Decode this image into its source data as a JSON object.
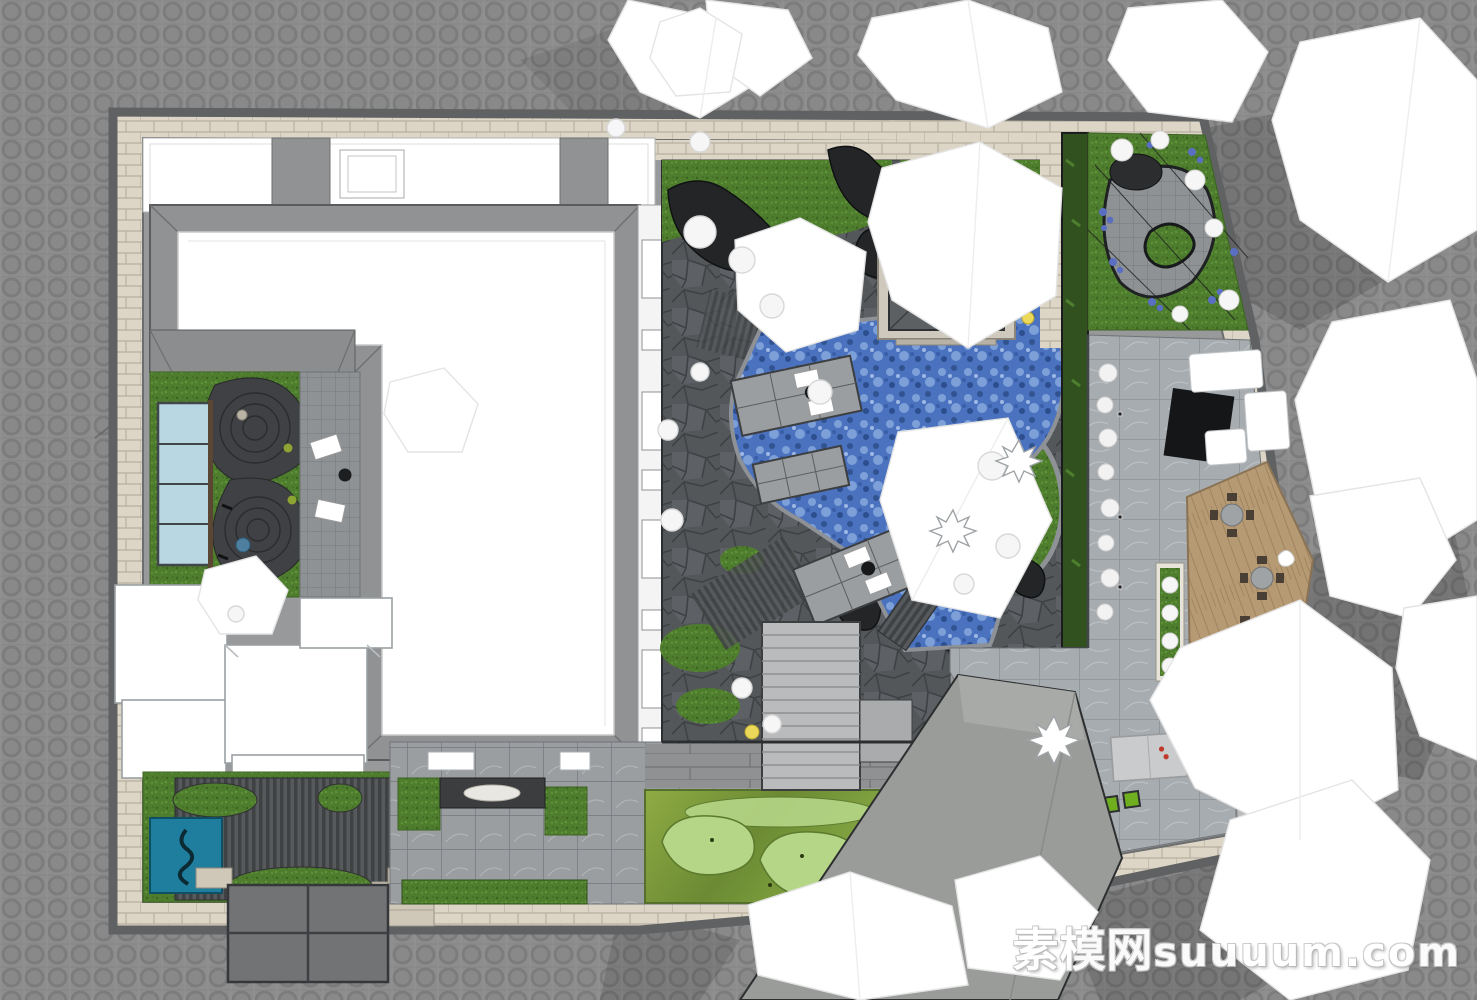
{
  "meta": {
    "view": "top-down-courtyard-landscape-plan",
    "render_style": "sketchup-axon-texture-render"
  },
  "watermark": {
    "cn": "素模网",
    "en": "suuuum.com"
  },
  "palette": {
    "bg": "#8d8d8d",
    "bgline": "#7c7c7c",
    "brick": "#ddd6c6",
    "brickline": "#b7afa0",
    "wall": "#909294",
    "walledge": "#5f6163",
    "roofwhite": "#ffffff",
    "grass": "#4e7d2d",
    "water": "#4a72bf",
    "rock": "#232527",
    "flag": "#54575a",
    "marble": "#a7acb0",
    "tilegrid": "#6f7478",
    "wood": "#b59a74",
    "golfbase": "#7c9c40",
    "golflight": "#b5d687",
    "teal": "#1f7d9e",
    "glass": "#b9d7e3",
    "ramp": "#9a9c9a",
    "canopy": "#ffffff",
    "canopyline": "#e4e4e4",
    "flower": "#5a6ec2",
    "lantern": "#ecd95a",
    "hedge": "#31511f",
    "darkdeck": "#43464a",
    "paleslab": "#cfc8b8"
  },
  "elements": [
    "site-boundary-wall",
    "perimeter-brick-path",
    "north-wing-roofs",
    "main-building-roof",
    "zen-garden",
    "zen-gravel-swirls",
    "skylight-window",
    "lounge-patio",
    "west-annex-roofs",
    "southwest-garden",
    "plunge-pool",
    "entrance-canopy",
    "south-tile-terrace",
    "water-bowl-feature",
    "putting-green",
    "bench-strip",
    "central-courtyard",
    "rockery",
    "koi-pond",
    "tea-pavilion",
    "deck-platforms",
    "lounge-chairs",
    "garden-stairs",
    "plank-bridge",
    "lantern-lights",
    "hedge-wall",
    "northeast-terrace",
    "flower-beds",
    "east-marble-terrace",
    "topiary-ball-row",
    "wood-dining-deck",
    "dining-table-sets",
    "planter-boxes",
    "outdoor-kitchen",
    "pingpong-table",
    "potted-plants",
    "driveway-ramp",
    "tree-canopies",
    "shrub-balls"
  ]
}
